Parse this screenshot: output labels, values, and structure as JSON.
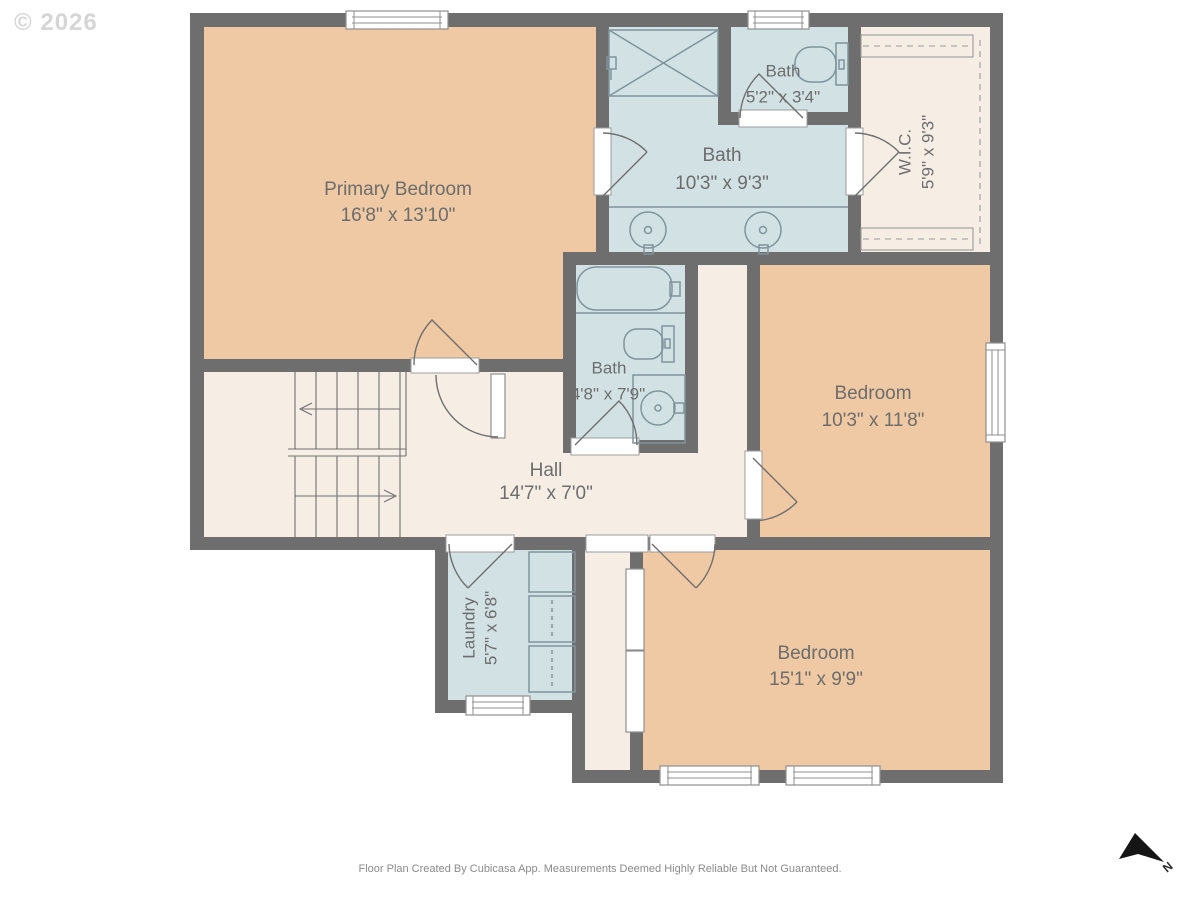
{
  "copyright": "© 2026",
  "footer": "Floor Plan Created By Cubicasa App. Measurements Deemed Highly Reliable But Not Guaranteed.",
  "compass": {
    "label": "N"
  },
  "palette": {
    "wall": "#6e6e6e",
    "bedroom": "#eec9a3",
    "bath": "#d2e1e3",
    "neutral": "#f6eee5",
    "fixture": "#7f949c",
    "label": "#6d6d6d"
  },
  "rooms": [
    {
      "id": "primary-bedroom",
      "name": "Primary Bedroom",
      "dims": "16'8\" x 13'10\""
    },
    {
      "id": "bath-main",
      "name": "Bath",
      "dims": "10'3\" x 9'3\""
    },
    {
      "id": "bath-small",
      "name": "Bath",
      "dims": "5'2\" x 3'4\""
    },
    {
      "id": "wic",
      "name": "W.I.C.",
      "dims": "5'9\" x 9'3\""
    },
    {
      "id": "bath-middle",
      "name": "Bath",
      "dims": "4'8\" x 7'9\""
    },
    {
      "id": "bedroom-east",
      "name": "Bedroom",
      "dims": "10'3\" x 11'8\""
    },
    {
      "id": "hall",
      "name": "Hall",
      "dims": "14'7\" x 7'0\""
    },
    {
      "id": "laundry",
      "name": "Laundry",
      "dims": "5'7\" x 6'8\""
    },
    {
      "id": "bedroom-south",
      "name": "Bedroom",
      "dims": "15'1\" x 9'9\""
    }
  ],
  "fixtures": [
    "shower",
    "double-vanity-sinks",
    "toilet",
    "bathtub",
    "sink",
    "washer-dryer-stack",
    "stairs",
    "closet-shelves"
  ]
}
